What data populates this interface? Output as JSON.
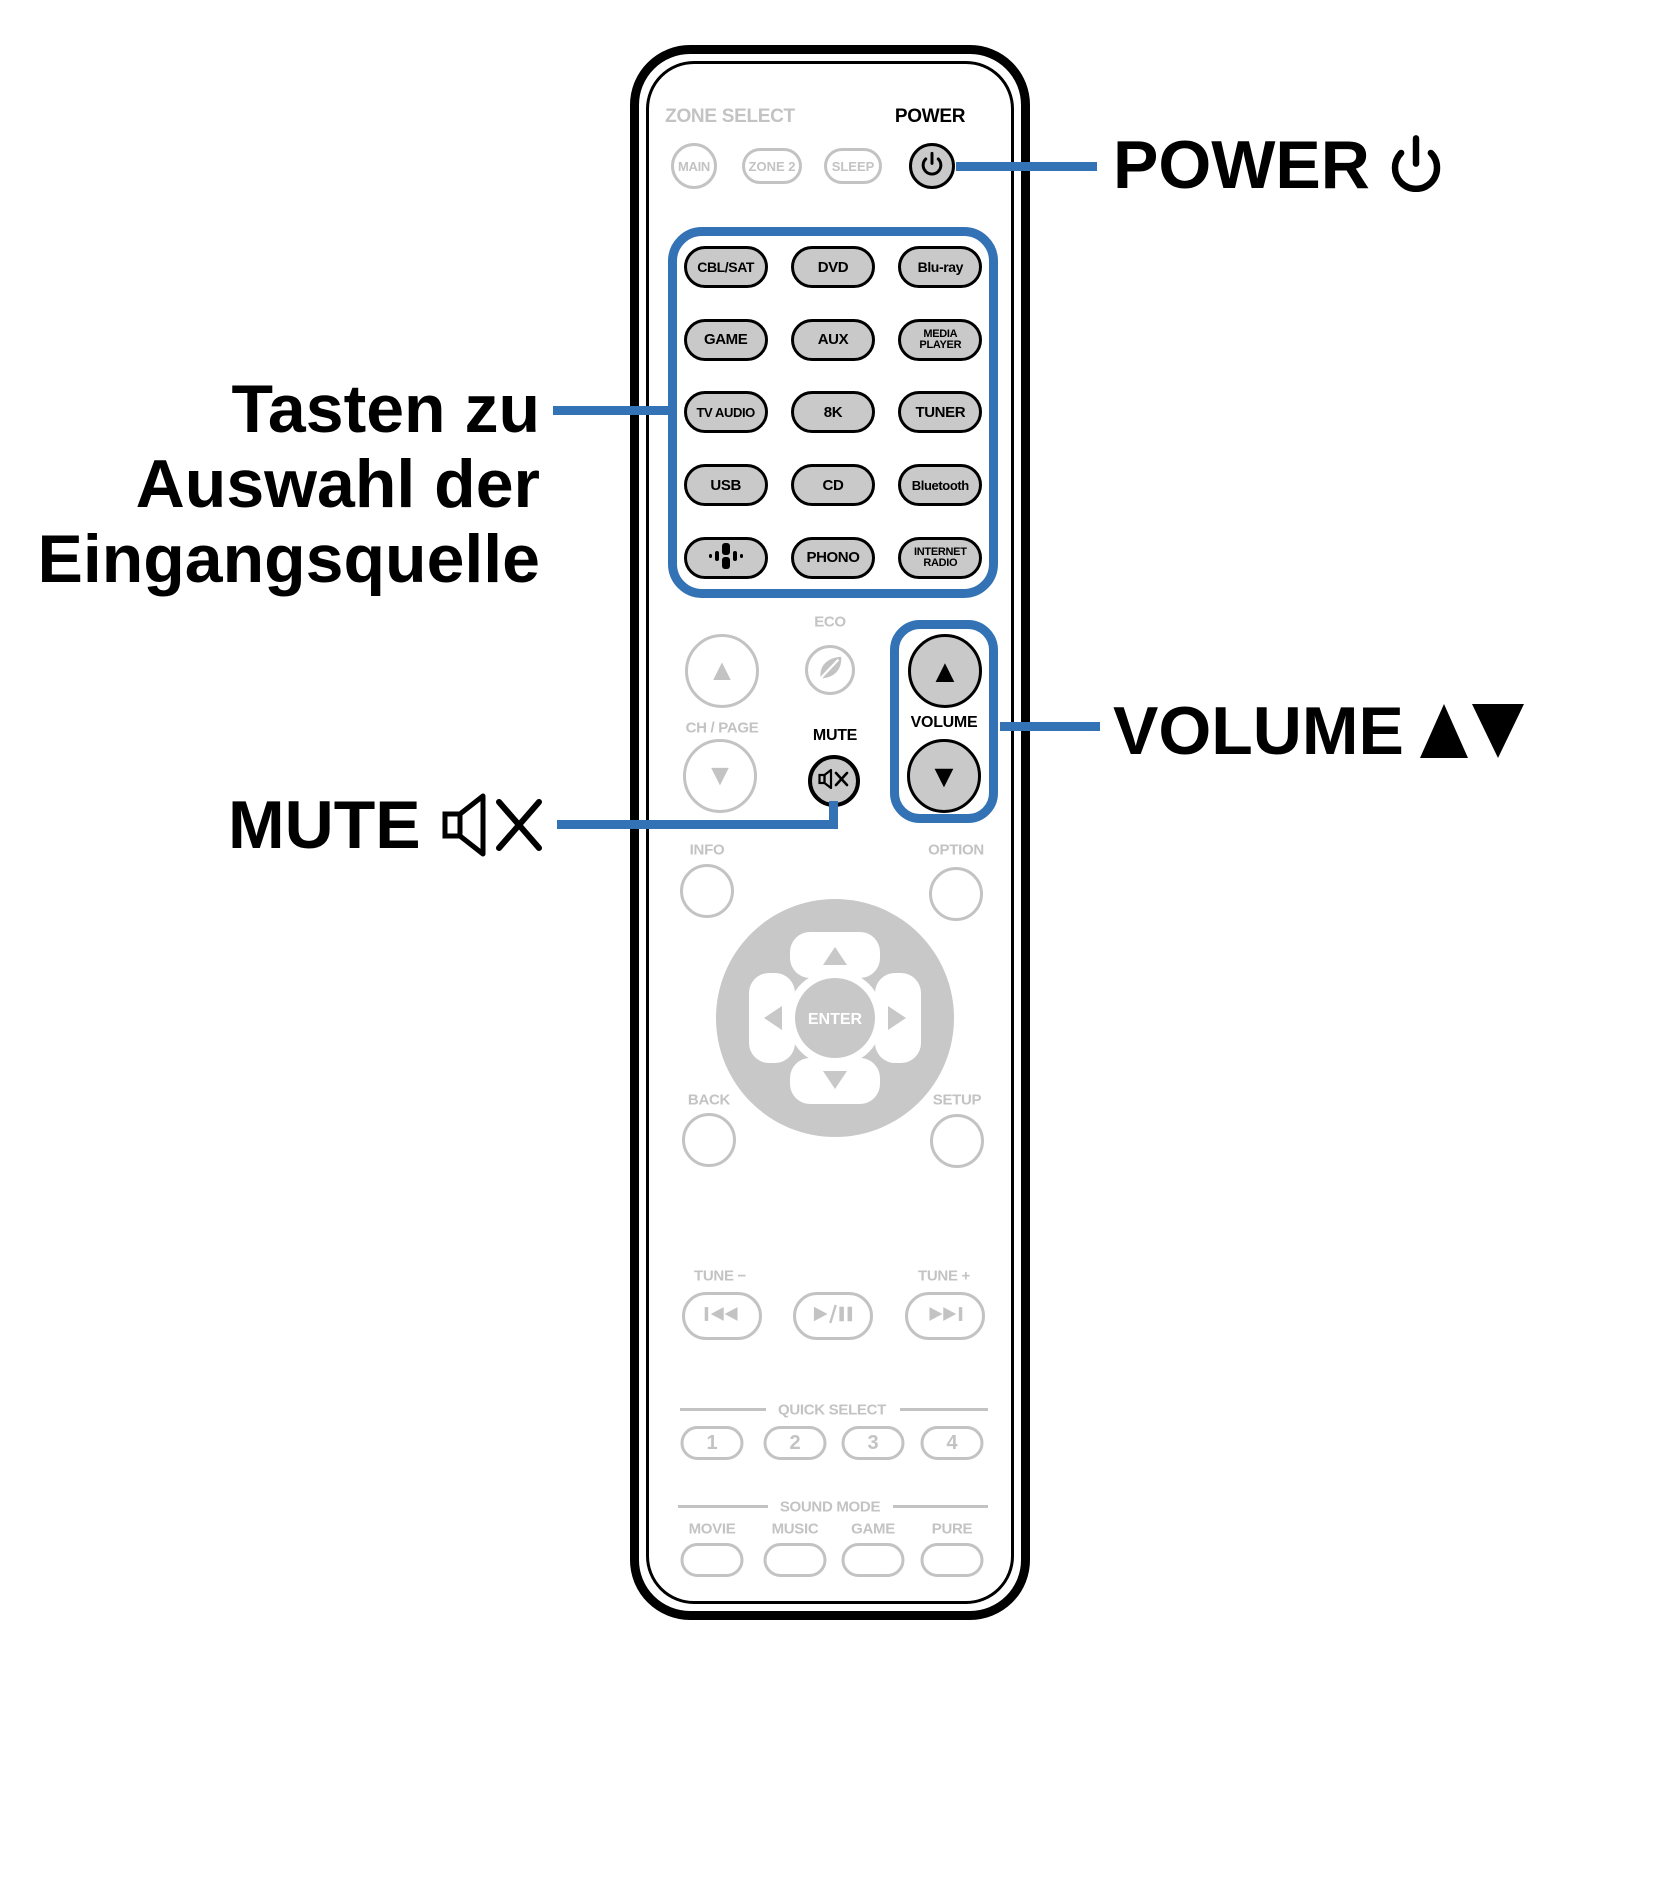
{
  "colors": {
    "accent_blue": "#3372b5",
    "button_gray": "#c9c9c9",
    "inactive_gray": "#c3c3c3",
    "outline_black": "#000000"
  },
  "annotations": {
    "power_label": "POWER",
    "input_source_lines": [
      "Tasten zu",
      "Auswahl der",
      "Eingangsquelle"
    ],
    "volume_label": "VOLUME",
    "mute_label": "MUTE"
  },
  "remote": {
    "zone_select_label": "ZONE SELECT",
    "zone_buttons": [
      {
        "label": "MAIN"
      },
      {
        "label": "ZONE 2"
      },
      {
        "label": "SLEEP"
      }
    ],
    "power_label": "POWER",
    "input_buttons": [
      {
        "label": "CBL/SAT"
      },
      {
        "label": "DVD"
      },
      {
        "label": "Blu-ray"
      },
      {
        "label": "GAME"
      },
      {
        "label": "AUX"
      },
      {
        "line1": "MEDIA",
        "line2": "PLAYER"
      },
      {
        "label": "TV AUDIO"
      },
      {
        "label": "8K"
      },
      {
        "label": "TUNER"
      },
      {
        "label": "USB"
      },
      {
        "label": "CD"
      },
      {
        "label": "Bluetooth"
      },
      {
        "icon": "heos"
      },
      {
        "label": "PHONO"
      },
      {
        "line1": "INTERNET",
        "line2": "RADIO"
      }
    ],
    "eco_label": "ECO",
    "ch_page_label": "CH / PAGE",
    "mute_label": "MUTE",
    "volume_label": "VOLUME",
    "info_label": "INFO",
    "option_label": "OPTION",
    "enter_label": "ENTER",
    "back_label": "BACK",
    "setup_label": "SETUP",
    "tune_minus_label": "TUNE −",
    "tune_plus_label": "TUNE +",
    "quick_select": {
      "label": "QUICK SELECT",
      "buttons": [
        "1",
        "2",
        "3",
        "4"
      ]
    },
    "sound_mode": {
      "label": "SOUND MODE",
      "buttons": [
        "MOVIE",
        "MUSIC",
        "GAME",
        "PURE"
      ]
    }
  }
}
